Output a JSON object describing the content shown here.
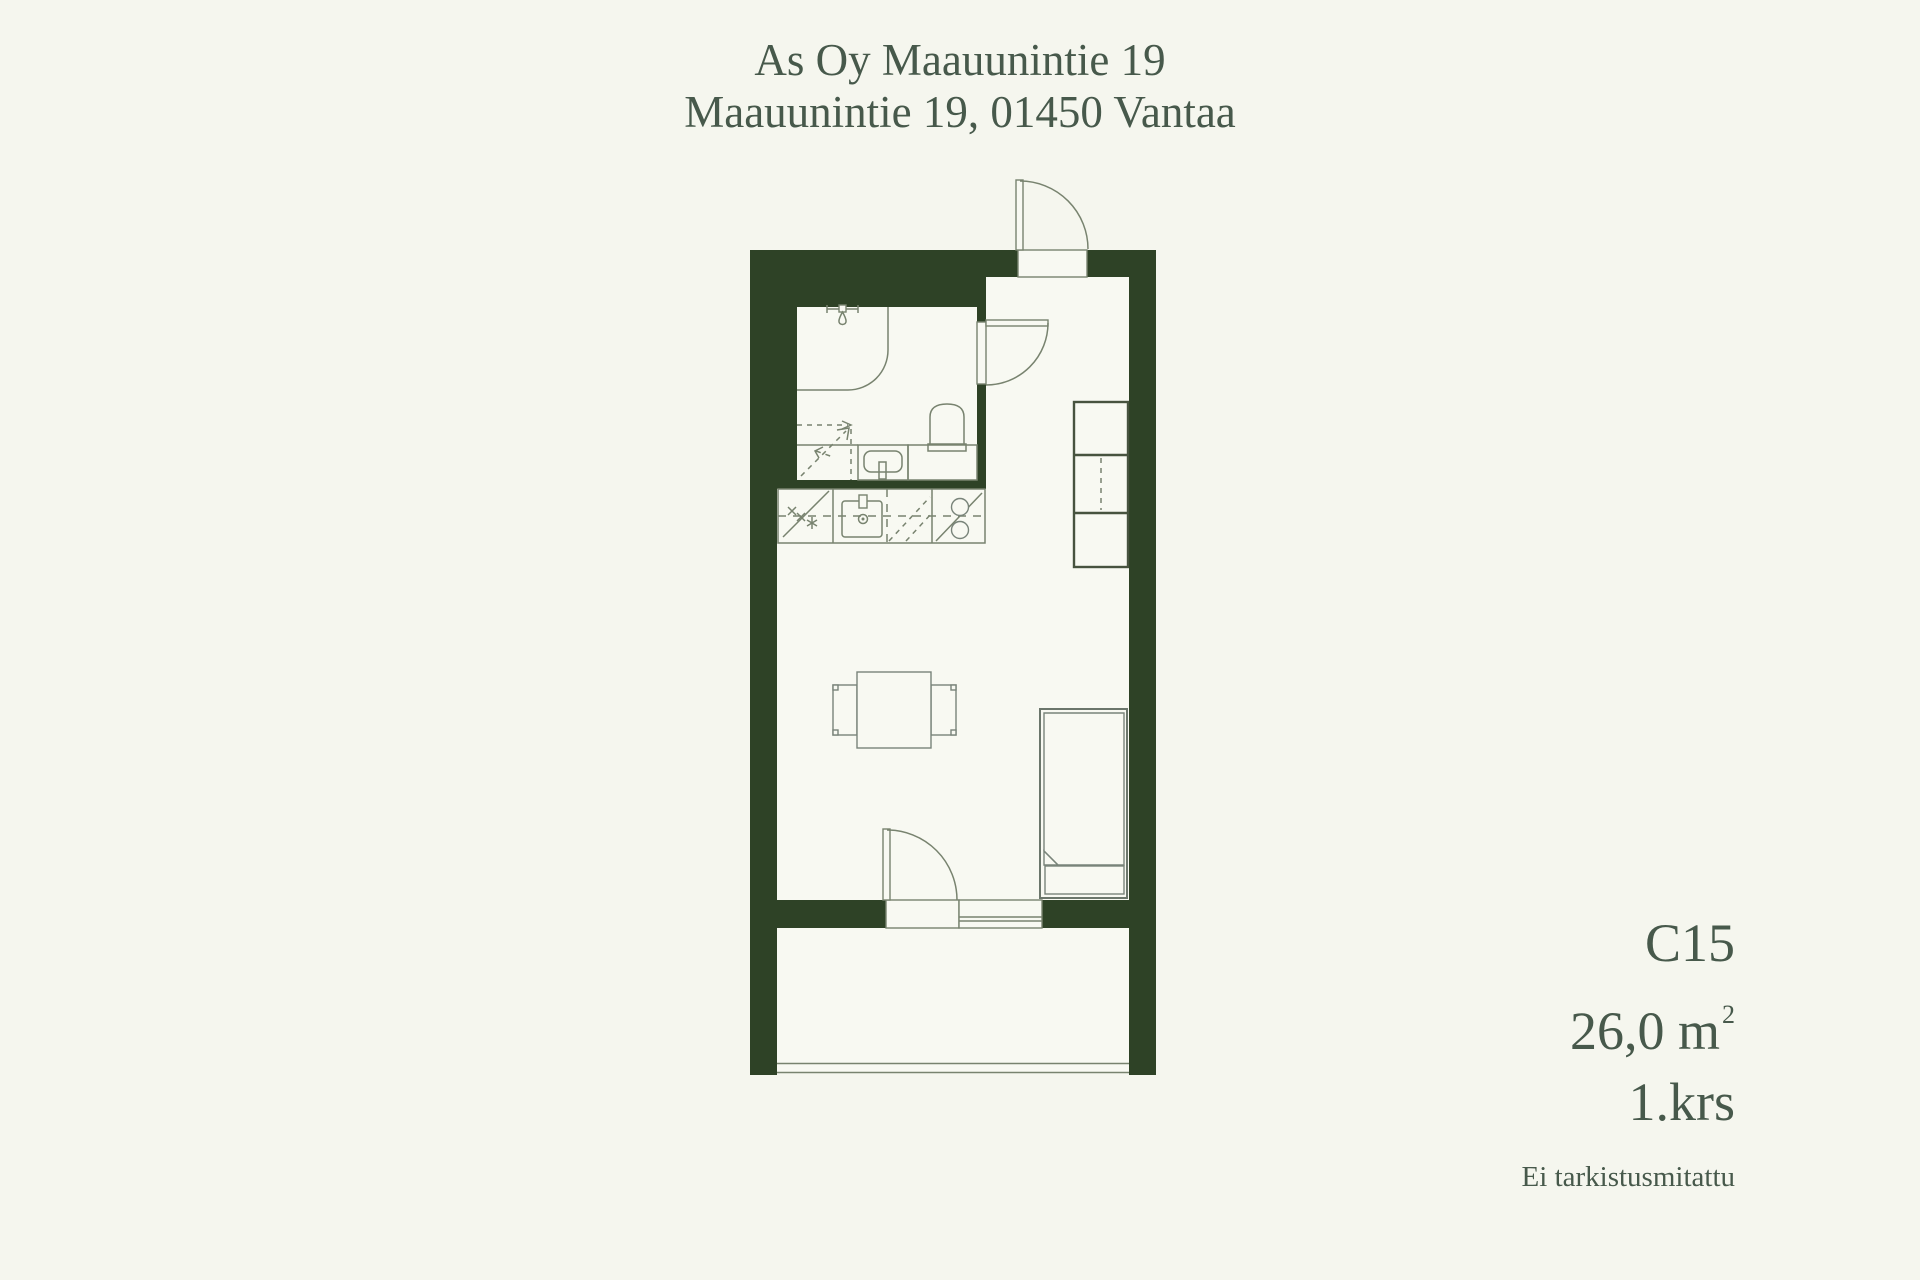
{
  "header": {
    "line1": "As Oy Maauunintie 19",
    "line2": "Maauunintie 19, 01450 Vantaa"
  },
  "info": {
    "apartment_id": "C15",
    "area_value": "26,0 m",
    "area_superscript": "2",
    "floor": "1.krs",
    "disclaimer": "Ei tarkistusmitattu"
  },
  "colors": {
    "background": "#f5f6ee",
    "floor": "#f8f9f2",
    "wall": "#2e4226",
    "line": "#78836f",
    "text": "#47594b"
  }
}
